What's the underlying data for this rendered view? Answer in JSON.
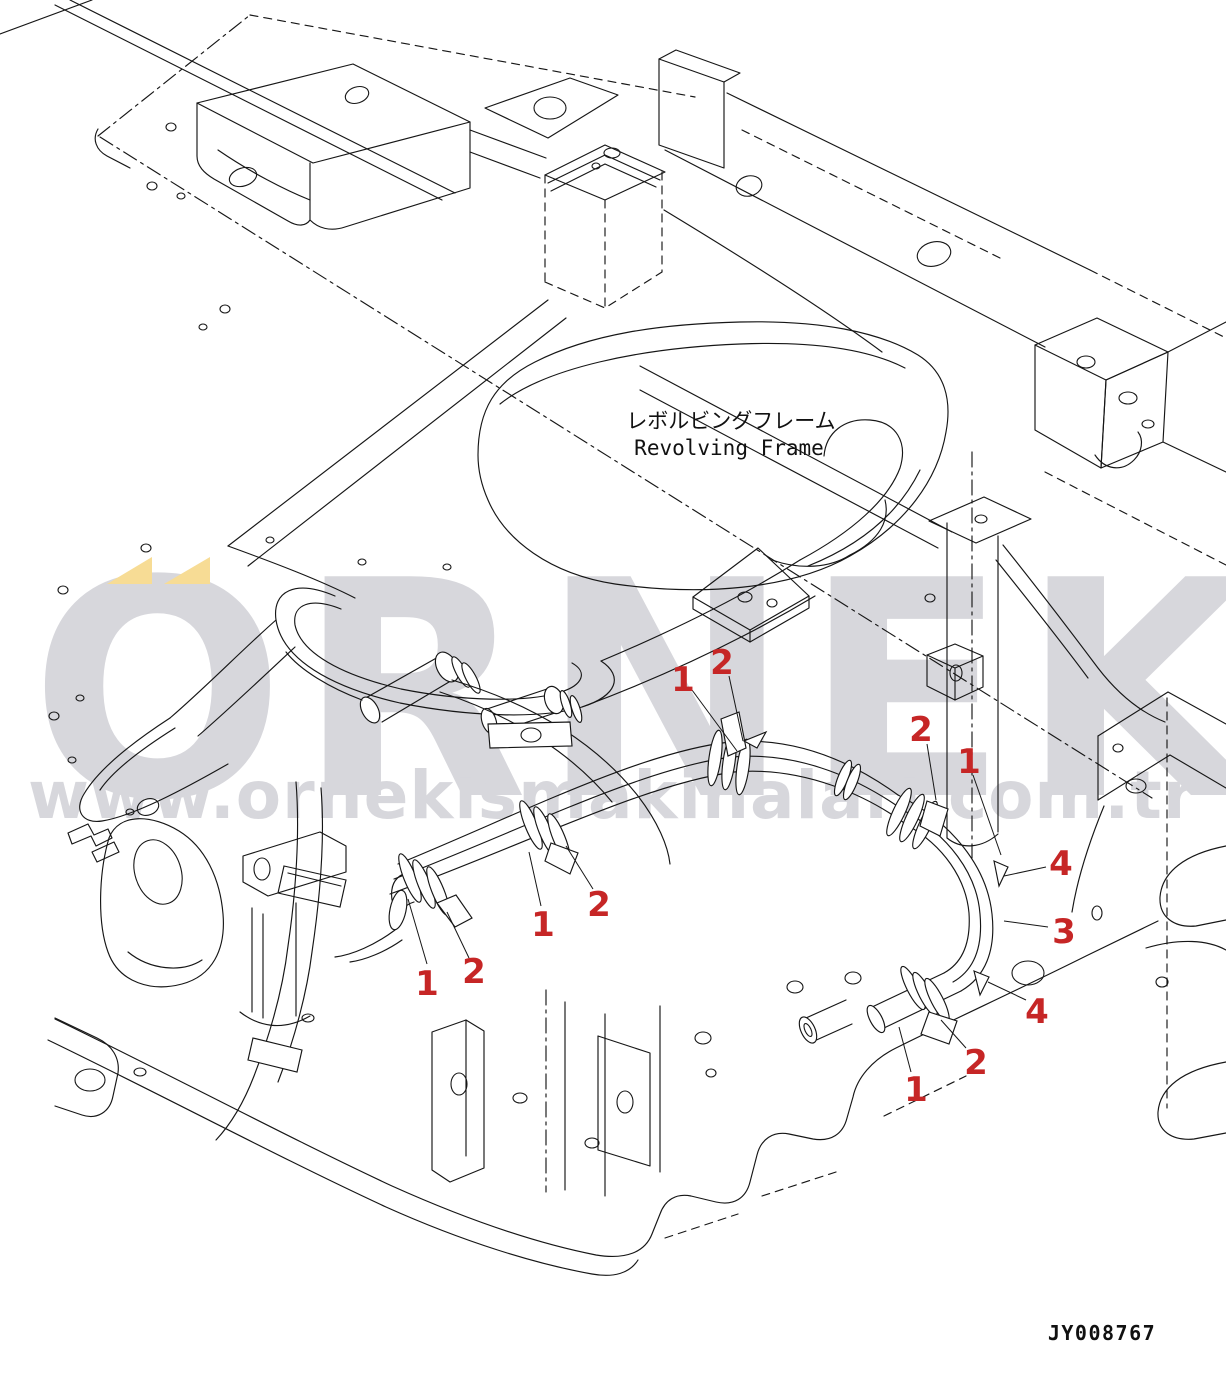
{
  "diagram": {
    "label": {
      "jp": "レボルビングフレーム",
      "en": "Revolving Frame"
    },
    "part_code": "JY008767",
    "callouts": [
      {
        "label": "1"
      },
      {
        "label": "2"
      },
      {
        "label": "2"
      },
      {
        "label": "1"
      },
      {
        "label": "1"
      },
      {
        "label": "2"
      },
      {
        "label": "1"
      },
      {
        "label": "2"
      },
      {
        "label": "4"
      },
      {
        "label": "3"
      },
      {
        "label": "4"
      },
      {
        "label": "2"
      },
      {
        "label": "1"
      }
    ]
  },
  "watermark": {
    "brand": "ORNEK",
    "url": "www.ornekismakinalari.com.tr",
    "gray_color": "#d7d7dc",
    "yellow_color": "#f7dc95"
  },
  "colors": {
    "line": "#161616",
    "callout_red": "#c62626",
    "background": "#ffffff"
  }
}
